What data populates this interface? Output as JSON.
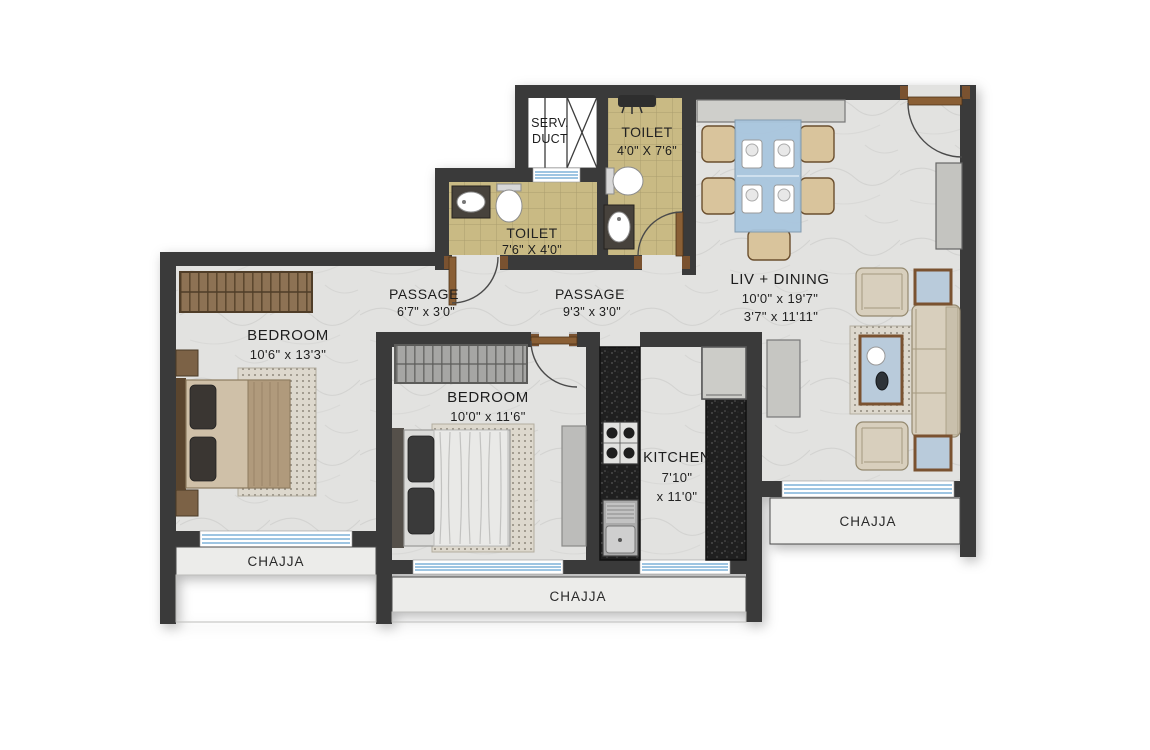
{
  "plan": {
    "title": "2 BHK apartment floor plan",
    "rooms": {
      "serv_duct": {
        "name_line1": "SERV.",
        "name_line2": "DUCT"
      },
      "toilet_top": {
        "name": "TOILET",
        "dims": "4'0\" X 7'6\""
      },
      "toilet_mid": {
        "name": "TOILET",
        "dims": "7'6\" X 4'0\""
      },
      "living": {
        "name": "LIV + DINING",
        "dims1": "10'0\" x 19'7\"",
        "dims2": "3'7\" x 11'11\""
      },
      "passage_left": {
        "name": "PASSAGE",
        "dims": "6'7\" x 3'0\""
      },
      "passage_right": {
        "name": "PASSAGE",
        "dims": "9'3\" x 3'0\""
      },
      "bedroom_left": {
        "name": "BEDROOM",
        "dims": "10'6\" x 13'3\""
      },
      "bedroom_mid": {
        "name": "BEDROOM",
        "dims": "10'0\" x 11'6\""
      },
      "kitchen": {
        "name": "KITCHEN",
        "dims1": "7'10\"",
        "dims2": "x 11'0\""
      },
      "chajja_left": {
        "name": "CHAJJA"
      },
      "chajja_bottom": {
        "name": "CHAJJA"
      },
      "chajja_right": {
        "name": "CHAJJA"
      }
    },
    "colors": {
      "wall": "#3a3a3a",
      "floor_marble": "#e2e2e0",
      "tile_bath": "#c9ba84",
      "granite_counter": "#1f1f1f",
      "wood_trim": "#7a5230",
      "window_glass": "#7fb2d8",
      "table_glass": "#a9c6de",
      "chajja_band": "#ececea"
    }
  }
}
